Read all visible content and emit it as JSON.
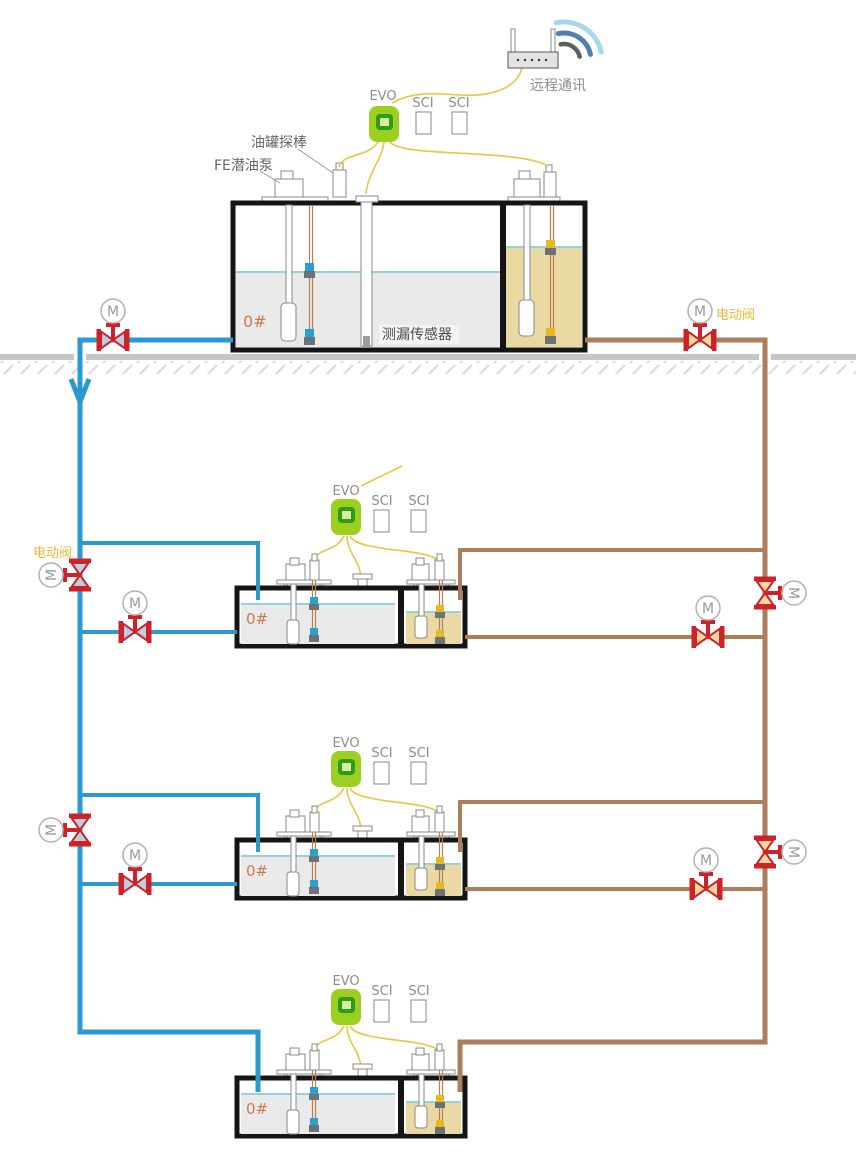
{
  "diagram": {
    "remote_comm_label": "远程通讯",
    "devices": {
      "evo": "EVO",
      "sci": "SCI"
    },
    "annotations": {
      "tank_probe": "油罐探棒",
      "fe_pump": "FE潜油泵",
      "leak_sensor": "测漏传感器",
      "electric_valve": "电动阀",
      "motor": "M",
      "fuel_grade": "0#"
    },
    "colors": {
      "pipe_blue": "#2b9ad0",
      "pipe_brown": "#ad7e59",
      "valve_red": "#cf2128",
      "wire_yellow": "#e9c63f",
      "evo_green": "#9cd01e",
      "sci_blue": "#a9d6e8",
      "diesel_liquid": "#eaeaea",
      "gasoline_liquid": "#ead9a2",
      "level_line": "#8fd2e0",
      "grade_label": "#cd7a4e",
      "electric_valve_label": "#e8b838",
      "ground": "#c6c6c6"
    }
  }
}
